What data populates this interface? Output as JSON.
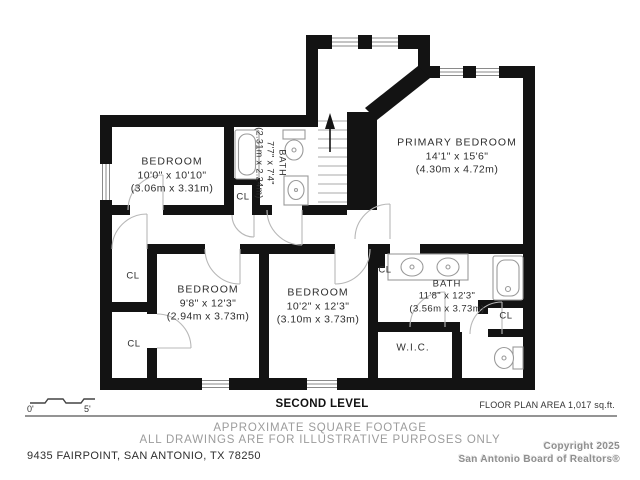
{
  "page": {
    "level_title": "SECOND LEVEL",
    "area_note": "FLOOR PLAN AREA 1,017 sq.ft.",
    "disclaimer_line1": "APPROXIMATE SQUARE FOOTAGE",
    "disclaimer_line2": "ALL DRAWINGS ARE FOR ILLUSTRATIVE PURPOSES ONLY",
    "address": "9435 FAIRPOINT, SAN ANTONIO, TX 78250",
    "copyright_line1": "Copyright 2025",
    "copyright_line2": "San Antonio Board of Realtors®",
    "scale": {
      "start": "0'",
      "end": "5'"
    }
  },
  "rooms": [
    {
      "name": "PRIMARY BEDROOM",
      "dims_ft": "14'1\" x 15'6\"",
      "dims_m": "(4.30m x 4.72m)"
    },
    {
      "name": "BEDROOM",
      "dims_ft": "10'0\" x 10'10\"",
      "dims_m": "(3.06m x 3.31m)"
    },
    {
      "name": "BATH",
      "dims_ft": "7'7\" x 7'4\"",
      "dims_m": "(2.31m x 2.24m)"
    },
    {
      "name": "BEDROOM",
      "dims_ft": "9'8\" x 12'3\"",
      "dims_m": "(2.94m x 3.73m)"
    },
    {
      "name": "BEDROOM",
      "dims_ft": "10'2\" x 12'3\"",
      "dims_m": "(3.10m x 3.73m)"
    },
    {
      "name": "BATH",
      "dims_ft": "11'8\" x 12'3\"",
      "dims_m": "(3.56m x 3.73m)"
    },
    {
      "name": "W.I.C."
    }
  ],
  "closet_label": "CL",
  "colors": {
    "wall": "#131313",
    "fixture_line": "#9a9a9a",
    "door_line": "#b8b8b8",
    "muted_text": "#9c9c9c",
    "text": "#2e2e2e"
  }
}
